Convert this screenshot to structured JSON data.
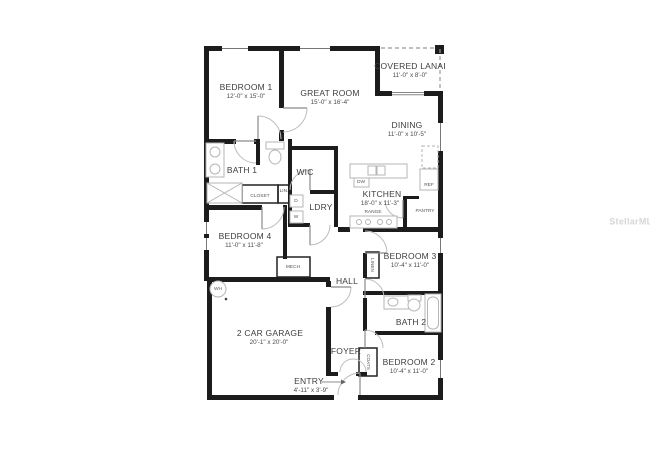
{
  "watermark": "StellarMLS",
  "rooms": [
    {
      "name": "BEDROOM 1",
      "dims": "12'-0\" x 15'-0\""
    },
    {
      "name": "GREAT ROOM",
      "dims": "15'-0\" x 16'-4\""
    },
    {
      "name": "COVERED LANAI",
      "dims": "11'-0\" x 8'-0\""
    },
    {
      "name": "DINING",
      "dims": "11'-0\" x 10'-5\""
    },
    {
      "name": "BATH 1"
    },
    {
      "name": "WIC"
    },
    {
      "name": "KITCHEN",
      "dims": "18'-0\" x 11'-3\""
    },
    {
      "name": "LDRY"
    },
    {
      "name": "BEDROOM 4",
      "dims": "11'-0\" x 11'-8\""
    },
    {
      "name": "BEDROOM 3",
      "dims": "10'-4\" x 11'-0\""
    },
    {
      "name": "HALL"
    },
    {
      "name": "2 CAR GARAGE",
      "dims": "20'-1\" x 20'-0\""
    },
    {
      "name": "BATH 2"
    },
    {
      "name": "FOYER"
    },
    {
      "name": "BEDROOM 2",
      "dims": "10'-4\" x 11'-0\""
    },
    {
      "name": "ENTRY",
      "dims": "4'-11\" x 3'-9\""
    }
  ],
  "fixtures": {
    "closet": "CLOSET",
    "linen_small": "LIN.",
    "dryer": "D",
    "washer": "W",
    "dishwasher": "DW",
    "refrigerator": "REF",
    "range": "RANGE",
    "pantry": "PANTRY",
    "mechanical": "MECH",
    "water_heater": "WH",
    "linen": "LINEN",
    "coats": "COATS"
  },
  "colors": {
    "wall": "#1c1c1c",
    "fixture_outline": "#b5b5b5",
    "door_arc": "#bdbdbd",
    "label": "#3e3e3e",
    "watermark": "#d6d6d6"
  }
}
